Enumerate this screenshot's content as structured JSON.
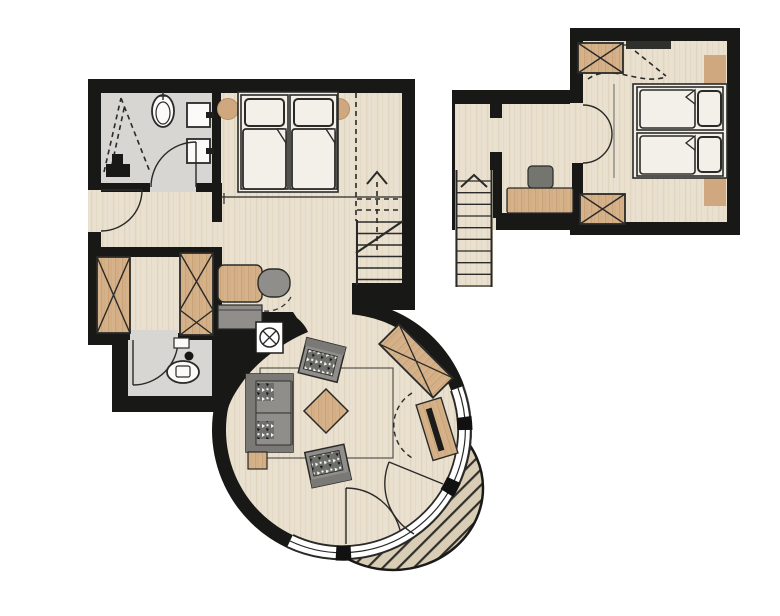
{
  "meta": {
    "drawing": "hotel-suite-floor-plan",
    "canvas": {
      "w": 780,
      "h": 616
    }
  },
  "palette": {
    "wall": "#181816",
    "floor_wood": "#e9e0cf",
    "floor_wood_grain": "#ddd0b8",
    "floor_upper": "#ece4d4",
    "floor_tile": "#d8d6d2",
    "furniture_wood": "#d6b28a",
    "furniture_wood_grain": "#c79e72",
    "furniture_wood_light": "#cfa87f",
    "upholstery_gray": "#8f8e8a",
    "upholstery_dark": "#7a7976",
    "seat_speckle_base": "#6e6e6a",
    "linen_white": "#f3f0e9",
    "fixture_white": "#fbfaf8",
    "deck_wood": "#d9cdb6",
    "deck_stripe": "#30302a",
    "window_white": "#ffffff",
    "tv_black": "#1b1b19",
    "outline_dark": "#2a2a28"
  },
  "plans": [
    {
      "id": "ground-floor",
      "rooms": [
        {
          "name": "bathroom",
          "fixtures": [
            "shower-dashed-screen",
            "toilet",
            "washbasin-1",
            "washbasin-2",
            "swing-door"
          ]
        },
        {
          "name": "entrance-hall",
          "fixtures": [
            "entry-door",
            "wardrobe-left",
            "wardrobe-right"
          ]
        },
        {
          "name": "wc",
          "fixtures": [
            "toilet",
            "cistern",
            "drain-dot",
            "swing-door"
          ]
        },
        {
          "name": "bedroom",
          "furniture": [
            "double-bed-two-mattresses",
            "bedside-stool-left",
            "bedside-stool-right",
            "desk",
            "desk-chair",
            "sideboard"
          ]
        },
        {
          "name": "staircase",
          "symbols": [
            "up-arrow",
            "dashed-headroom-boundary",
            "break-line"
          ]
        },
        {
          "name": "living-room",
          "furniture": [
            "sofa",
            "armchair-top",
            "armchair-bottom",
            "coffee-table-diamond",
            "side-table",
            "tv-board",
            "corner-wardrobe"
          ],
          "features": [
            "curved-window-wall",
            "balcony-double-door",
            "floor-shaft-symbol",
            "rug-outline"
          ]
        },
        {
          "name": "balcony",
          "features": [
            "semicircular-plank-deck"
          ]
        }
      ]
    },
    {
      "id": "upper-floor",
      "rooms": [
        {
          "name": "landing",
          "furniture": [
            "desk",
            "chair"
          ],
          "features": [
            "staircase-down",
            "up-arrow",
            "partition-stubs",
            "open-gallery-edge"
          ]
        },
        {
          "name": "bedroom",
          "furniture": [
            "double-bed-two-mattresses",
            "wardrobe-top",
            "wardrobe-bottom",
            "nightstand-top",
            "nightstand-bottom"
          ],
          "features": [
            "double-swing-door",
            "skylight-bar",
            "roof-slope-dashed-lines"
          ]
        }
      ]
    }
  ]
}
